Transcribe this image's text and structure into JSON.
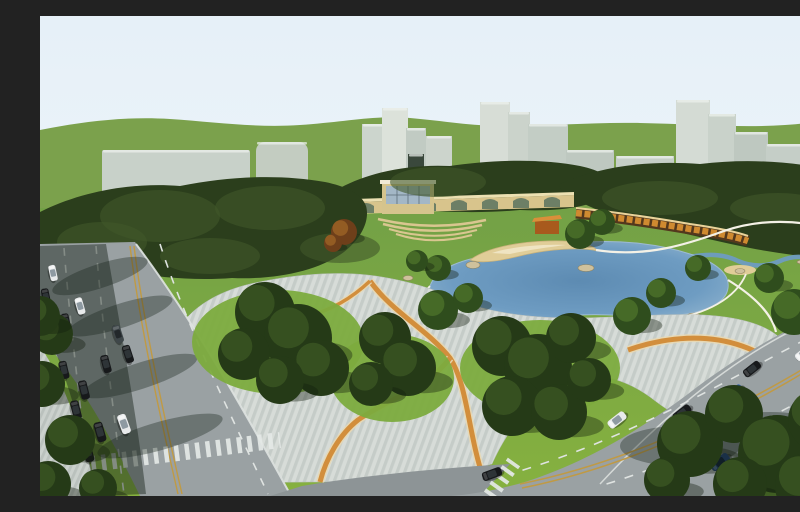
{
  "image": {
    "type": "3d-architectural-rendering",
    "subject": "Aerial perspective rendering of an urban park master plan: central lake with sandy beach, striped plaza with orange ribbon paths, tree groves, arched colonnade wall with glass pavilion, orange terraced wall, perimeter roads with car traffic, and pale city towers on rolling green hills",
    "width": 800,
    "height": 480
  },
  "colors": {
    "sky_top": "#e6f0f8",
    "sky_bottom": "#f3f8fb",
    "hill": "#7ba14c",
    "lawn_top": "#73a146",
    "lawn_bottom": "#86b13f",
    "forest": "#2b3e1c",
    "forest_light": "#41582a",
    "wall_tan": "#d8c48c",
    "wall_top": "#ece0b2",
    "arch_opening": "#6d7f66",
    "pavilion_frame": "#d5c48d",
    "pavilion_roof": "#f0ead6",
    "glass": "#a3b7c6",
    "glass_grid": "#5d6d78",
    "amph_step": "#d9c690",
    "terrace_dark": "#53381d",
    "terrace_orange": "#cf8a30",
    "terrace_top": "#ead39a",
    "orange_pavilion": "#a85a1d",
    "orange_pavilion_roof": "#d98f3a",
    "lake_edge": "#93b6d0",
    "lake_mid": "#6e9cc2",
    "lake_deep": "#5d8bb2",
    "sand": "#e0cd98",
    "sand_light": "#efe4c2",
    "rock": "#cfc19c",
    "path_white": "#f4f1e6",
    "plaza_bg": "#d7dcd8",
    "plaza_stripe": "#c5ccc8",
    "sidewalk_bg": "#cbd1cd",
    "sidewalk_stripe": "#bac1bd",
    "orange_band": "#d28e3c",
    "orange_band_halo": "#e8d8b2",
    "road": "#9aa1a3",
    "road_dark": "#8d9496",
    "road_edge_white": "#dfe3e1",
    "lane_yellow": "#c09a44",
    "crosswalk": "#e4e8e6",
    "mound": "#7cab3e",
    "corner_green": "#5d8731",
    "shadow_band": "rgba(22,34,24,0.45)",
    "shadow_blob": "rgba(20,32,22,0.35)"
  },
  "scene": {
    "buildings": [
      [
        62,
        134,
        148,
        44,
        "#c8d1c9",
        2
      ],
      [
        216,
        126,
        52,
        57,
        "#c3ccc1",
        9
      ],
      [
        322,
        108,
        22,
        62,
        "#ccd5cd",
        0
      ],
      [
        342,
        92,
        26,
        78,
        "#dce2da",
        0
      ],
      [
        366,
        112,
        20,
        60,
        "#c1cbc3",
        0
      ],
      [
        386,
        120,
        26,
        52,
        "#ccd4cc",
        0
      ],
      [
        368,
        138,
        16,
        56,
        "#3a483c",
        0
      ],
      [
        440,
        86,
        30,
        84,
        "#d7ddd6",
        0
      ],
      [
        468,
        96,
        22,
        74,
        "#cbd3cb",
        0
      ],
      [
        488,
        108,
        40,
        64,
        "#c3cdc5",
        0
      ],
      [
        526,
        134,
        48,
        40,
        "#bec8c0",
        0
      ],
      [
        576,
        140,
        58,
        34,
        "#c6cfc7",
        0
      ],
      [
        636,
        84,
        34,
        102,
        "#d4dbd4",
        0
      ],
      [
        668,
        98,
        28,
        88,
        "#c9d2ca",
        0
      ],
      [
        694,
        116,
        34,
        72,
        "#bec8c0",
        0
      ],
      [
        726,
        128,
        44,
        62,
        "#c5cec7",
        0
      ],
      [
        766,
        116,
        32,
        76,
        "#cdd5cd",
        0
      ],
      [
        742,
        152,
        58,
        42,
        "#b8c2ba",
        0
      ]
    ],
    "arch": {
      "x0": 256,
      "dx": 31,
      "count": 9,
      "y0": 199,
      "dy": 1.0,
      "w": 16,
      "h": 7
    },
    "forest_highlights": [
      [
        120,
        200,
        60,
        26
      ],
      [
        230,
        192,
        55,
        22
      ],
      [
        62,
        226,
        45,
        20
      ],
      [
        398,
        166,
        48,
        15
      ],
      [
        620,
        182,
        58,
        17
      ],
      [
        738,
        192,
        48,
        15
      ],
      [
        300,
        232,
        40,
        15
      ],
      [
        170,
        240,
        50,
        18
      ]
    ],
    "rocks": [
      [
        433,
        249,
        7,
        3.5
      ],
      [
        546,
        252,
        8,
        3.5
      ],
      [
        420,
        291,
        6,
        3
      ],
      [
        654,
        300,
        7,
        3
      ],
      [
        700,
        255,
        5,
        2.5
      ],
      [
        762,
        246,
        5,
        2
      ],
      [
        368,
        262,
        5,
        2.5
      ]
    ],
    "tree_tones": {
      "dark": [
        "#253a17",
        "#3a5522"
      ],
      "mid": [
        "#2f4d1d",
        "#4a7029"
      ],
      "light": [
        "#3a6323",
        "#5d8f35"
      ],
      "autumn": [
        "#6e3f1a",
        "#9a6226"
      ]
    },
    "trees": [
      [
        225,
        296,
        30,
        "dark"
      ],
      [
        258,
        322,
        34,
        "dark"
      ],
      [
        204,
        338,
        26,
        "dark"
      ],
      [
        281,
        352,
        28,
        "dark"
      ],
      [
        240,
        364,
        24,
        "dark"
      ],
      [
        345,
        322,
        26,
        "dark"
      ],
      [
        368,
        352,
        28,
        "dark"
      ],
      [
        331,
        368,
        22,
        "dark"
      ],
      [
        398,
        294,
        20,
        "mid"
      ],
      [
        428,
        282,
        15,
        "mid"
      ],
      [
        462,
        330,
        30,
        "dark"
      ],
      [
        498,
        352,
        34,
        "dark"
      ],
      [
        531,
        322,
        25,
        "dark"
      ],
      [
        472,
        390,
        30,
        "dark"
      ],
      [
        519,
        396,
        28,
        "dark"
      ],
      [
        549,
        364,
        22,
        "dark"
      ],
      [
        592,
        300,
        19,
        "mid"
      ],
      [
        621,
        277,
        15,
        "mid"
      ],
      [
        658,
        252,
        13,
        "mid"
      ],
      [
        754,
        296,
        23,
        "mid"
      ],
      [
        781,
        272,
        19,
        "mid"
      ],
      [
        729,
        262,
        15,
        "mid"
      ],
      [
        787,
        318,
        16,
        "mid"
      ],
      [
        540,
        218,
        15,
        "mid"
      ],
      [
        562,
        206,
        13,
        "mid"
      ],
      [
        398,
        252,
        13,
        "mid"
      ],
      [
        377,
        245,
        11,
        "mid"
      ],
      [
        304,
        216,
        13,
        "autumn"
      ],
      [
        293,
        227,
        9,
        "autumn"
      ]
    ],
    "front_trees": [
      [
        650,
        428,
        33,
        "dark"
      ],
      [
        694,
        398,
        29,
        "dark"
      ],
      [
        737,
        438,
        39,
        "dark"
      ],
      [
        779,
        404,
        31,
        "dark"
      ],
      [
        700,
        468,
        27,
        "dark"
      ],
      [
        768,
        470,
        33,
        "dark"
      ],
      [
        627,
        464,
        23,
        "dark"
      ],
      [
        798,
        444,
        28,
        "dark"
      ],
      [
        12,
        318,
        21,
        "dark"
      ],
      [
        0,
        300,
        20,
        "dark"
      ],
      [
        2,
        368,
        23,
        "dark"
      ],
      [
        30,
        424,
        25,
        "dark"
      ],
      [
        8,
        468,
        23,
        "dark"
      ],
      [
        58,
        472,
        19,
        "dark"
      ]
    ],
    "car_palette": {
      "white": [
        "#e8eaeb",
        "#8e9aa2"
      ],
      "black": [
        "#17191b",
        "#2e3437"
      ],
      "blue": [
        "#2b5cae",
        "#16325e"
      ],
      "darkblue": [
        "#1f3d6b",
        "#101f38"
      ],
      "gray": [
        "#3f474a",
        "#23282b"
      ]
    },
    "cars": [
      [
        13,
        257,
        78,
        "white",
        0.8
      ],
      [
        40,
        290,
        74,
        "white",
        0.85
      ],
      [
        26,
        306,
        78,
        "black",
        0.85
      ],
      [
        78,
        318,
        72,
        "gray",
        0.9
      ],
      [
        88,
        338,
        72,
        "black",
        0.9
      ],
      [
        66,
        348,
        75,
        "black",
        0.9
      ],
      [
        44,
        374,
        76,
        "black",
        0.95
      ],
      [
        60,
        416,
        74,
        "black",
        1.0
      ],
      [
        84,
        408,
        70,
        "white",
        1.0
      ],
      [
        6,
        281,
        78,
        "black",
        0.85
      ],
      [
        14,
        313,
        78,
        "black",
        0.85
      ],
      [
        24,
        354,
        77,
        "black",
        0.9
      ],
      [
        36,
        394,
        76,
        "black",
        0.95
      ],
      [
        48,
        436,
        75,
        "black",
        1.0
      ],
      [
        764,
        337,
        -38,
        "white",
        0.95
      ],
      [
        712,
        353,
        -38,
        "black",
        0.95
      ],
      [
        694,
        377,
        -38,
        "blue",
        1.0
      ],
      [
        777,
        382,
        -38,
        "black",
        1.0
      ],
      [
        642,
        397,
        -38,
        "black",
        1.0
      ],
      [
        577,
        404,
        -38,
        "white",
        1.0
      ],
      [
        680,
        446,
        -38,
        "darkblue",
        1.05
      ],
      [
        452,
        458,
        -20,
        "black",
        1.0
      ]
    ]
  }
}
